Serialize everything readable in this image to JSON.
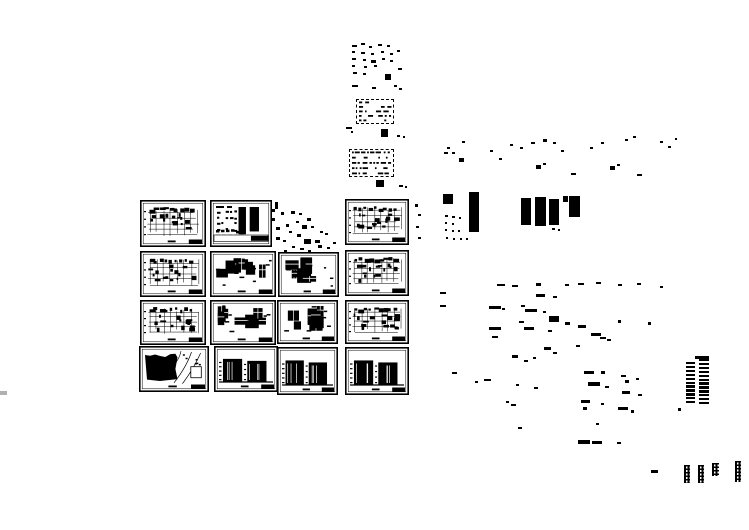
{
  "meta": {
    "title": "Architectural CAD drawing set preview",
    "bg": "#ffffff",
    "ink": "#000000",
    "canvas": {
      "width": 749,
      "height": 530
    }
  },
  "sheets": [
    {
      "id": "structural-plan-1",
      "kind": "plan-grid",
      "x": 140,
      "y": 200,
      "w": 66,
      "h": 47,
      "seed": 11
    },
    {
      "id": "heavy-wall-plan",
      "kind": "heavy-plan",
      "x": 210,
      "y": 200,
      "w": 62,
      "h": 47,
      "seed": 22
    },
    {
      "id": "floor-plan-1",
      "kind": "plan-grid",
      "x": 345,
      "y": 199,
      "w": 64,
      "h": 46,
      "seed": 33
    },
    {
      "id": "structural-plan-2",
      "kind": "plan-grid",
      "x": 140,
      "y": 251,
      "w": 66,
      "h": 46,
      "seed": 44
    },
    {
      "id": "detail-sheet-1",
      "kind": "detail-sheet",
      "x": 210,
      "y": 251,
      "w": 66,
      "h": 46,
      "seed": 55
    },
    {
      "id": "detail-sheet-2",
      "kind": "detail-sheet",
      "x": 278,
      "y": 252,
      "w": 61,
      "h": 45,
      "seed": 66
    },
    {
      "id": "floor-plan-2",
      "kind": "plan-grid",
      "x": 345,
      "y": 250,
      "w": 64,
      "h": 46,
      "seed": 77
    },
    {
      "id": "structural-plan-3",
      "kind": "plan-grid",
      "x": 140,
      "y": 300,
      "w": 66,
      "h": 45,
      "seed": 88
    },
    {
      "id": "detail-sheet-3",
      "kind": "detail-sheet",
      "x": 210,
      "y": 300,
      "w": 66,
      "h": 45,
      "seed": 99
    },
    {
      "id": "detail-sheet-4",
      "kind": "detail-sheet",
      "x": 277,
      "y": 300,
      "w": 61,
      "h": 44,
      "seed": 110
    },
    {
      "id": "floor-plan-3",
      "kind": "plan-grid",
      "x": 345,
      "y": 300,
      "w": 64,
      "h": 44,
      "seed": 121
    },
    {
      "id": "site-plan",
      "kind": "site-plan",
      "x": 139,
      "y": 346,
      "w": 70,
      "h": 46,
      "seed": 132
    },
    {
      "id": "elevation-1",
      "kind": "elevation",
      "x": 214,
      "y": 346,
      "w": 64,
      "h": 46,
      "seed": 143
    },
    {
      "id": "elevation-2",
      "kind": "elevation",
      "x": 277,
      "y": 347,
      "w": 61,
      "h": 48,
      "seed": 154
    },
    {
      "id": "elevation-3",
      "kind": "elevation",
      "x": 345,
      "y": 347,
      "w": 64,
      "h": 48,
      "seed": 165
    }
  ],
  "text_tables": [
    {
      "id": "spec-table-upper",
      "x": 356,
      "y": 99,
      "w": 36,
      "h": 23,
      "rows": 5,
      "seed": 7
    },
    {
      "id": "spec-table-lower",
      "x": 349,
      "y": 149,
      "w": 43,
      "h": 26,
      "rows": 5,
      "seed": 9
    }
  ],
  "tall_elevation": {
    "id": "high-rise-elevation",
    "top_bar": [
      695,
      356,
      14,
      3
    ],
    "columns": [
      {
        "x": 686,
        "w": 9,
        "y0": 362,
        "rows": 11
      },
      {
        "x": 699,
        "w": 10,
        "y0": 359,
        "rows": 12
      }
    ],
    "bar_h": 2.4,
    "pitch": 3.9
  },
  "dot_columns": [
    {
      "x": 684,
      "y": 465,
      "w": 6,
      "h": 18
    },
    {
      "x": 698,
      "y": 465,
      "w": 6,
      "h": 18
    },
    {
      "x": 712,
      "y": 463,
      "w": 7,
      "h": 13
    },
    {
      "x": 735,
      "y": 461,
      "w": 6,
      "h": 21
    }
  ],
  "marks": [
    [
      275,
      202,
      3,
      7
    ],
    [
      281,
      212,
      3,
      3
    ],
    [
      291,
      211,
      4,
      3
    ],
    [
      299,
      213,
      3,
      2
    ],
    [
      307,
      218,
      4,
      3
    ],
    [
      296,
      221,
      3,
      2
    ],
    [
      286,
      224,
      3,
      3
    ],
    [
      276,
      227,
      4,
      3
    ],
    [
      302,
      225,
      5,
      4
    ],
    [
      311,
      226,
      3,
      2
    ],
    [
      289,
      231,
      3,
      2
    ],
    [
      297,
      234,
      4,
      3
    ],
    [
      276,
      237,
      4,
      3
    ],
    [
      283,
      240,
      3,
      2
    ],
    [
      304,
      239,
      7,
      5
    ],
    [
      315,
      240,
      5,
      3
    ],
    [
      292,
      246,
      3,
      2
    ],
    [
      300,
      248,
      4,
      2
    ],
    [
      284,
      250,
      3,
      2
    ],
    [
      308,
      250,
      3,
      2
    ],
    [
      272,
      209,
      3,
      3
    ],
    [
      272,
      218,
      3,
      3
    ],
    [
      320,
      231,
      3,
      2
    ],
    [
      325,
      233,
      3,
      2
    ],
    [
      318,
      245,
      4,
      3
    ],
    [
      327,
      247,
      3,
      2
    ],
    [
      333,
      242,
      3,
      2
    ],
    [
      415,
      204,
      3,
      3
    ],
    [
      418,
      214,
      3,
      2
    ],
    [
      416,
      226,
      3,
      2
    ],
    [
      418,
      237,
      3,
      2
    ],
    [
      352,
      45,
      5,
      2
    ],
    [
      361,
      43,
      4,
      2
    ],
    [
      369,
      46,
      3,
      2
    ],
    [
      378,
      44,
      4,
      2
    ],
    [
      387,
      45,
      3,
      2
    ],
    [
      397,
      50,
      3,
      2
    ],
    [
      352,
      51,
      3,
      2
    ],
    [
      361,
      52,
      4,
      2
    ],
    [
      371,
      53,
      3,
      2
    ],
    [
      381,
      51,
      3,
      2
    ],
    [
      390,
      53,
      3,
      2
    ],
    [
      352,
      58,
      4,
      2
    ],
    [
      363,
      59,
      3,
      2
    ],
    [
      371,
      60,
      5,
      3
    ],
    [
      382,
      58,
      3,
      2
    ],
    [
      390,
      60,
      3,
      2
    ],
    [
      352,
      65,
      3,
      2
    ],
    [
      364,
      66,
      3,
      2
    ],
    [
      374,
      65,
      3,
      2
    ],
    [
      353,
      72,
      4,
      2
    ],
    [
      363,
      73,
      3,
      2
    ],
    [
      385,
      74,
      6,
      6
    ],
    [
      398,
      68,
      4,
      2
    ],
    [
      352,
      85,
      6,
      2
    ],
    [
      372,
      87,
      4,
      2
    ],
    [
      394,
      85,
      3,
      2
    ],
    [
      399,
      88,
      3,
      2
    ],
    [
      346,
      127,
      6,
      2
    ],
    [
      351,
      131,
      2,
      2
    ],
    [
      381,
      129,
      7,
      8
    ],
    [
      397,
      135,
      3,
      2
    ],
    [
      403,
      136,
      2,
      2
    ],
    [
      376,
      180,
      8,
      7
    ],
    [
      399,
      185,
      4,
      2
    ],
    [
      405,
      186,
      2,
      2
    ],
    [
      447,
      147,
      3,
      2
    ],
    [
      444,
      152,
      4,
      2
    ],
    [
      452,
      152,
      3,
      2
    ],
    [
      459,
      158,
      5,
      4
    ],
    [
      462,
      141,
      3,
      2
    ],
    [
      490,
      150,
      3,
      2
    ],
    [
      499,
      158,
      3,
      2
    ],
    [
      510,
      144,
      3,
      2
    ],
    [
      520,
      147,
      3,
      2
    ],
    [
      531,
      142,
      4,
      2
    ],
    [
      543,
      139,
      4,
      3
    ],
    [
      553,
      142,
      3,
      2
    ],
    [
      561,
      150,
      3,
      2
    ],
    [
      536,
      165,
      5,
      4
    ],
    [
      543,
      163,
      3,
      2
    ],
    [
      571,
      173,
      5,
      2
    ],
    [
      590,
      147,
      3,
      2
    ],
    [
      601,
      142,
      3,
      2
    ],
    [
      610,
      166,
      5,
      4
    ],
    [
      617,
      164,
      3,
      2
    ],
    [
      637,
      174,
      5,
      2
    ],
    [
      625,
      139,
      3,
      2
    ],
    [
      633,
      136,
      3,
      2
    ],
    [
      660,
      141,
      3,
      2
    ],
    [
      668,
      146,
      3,
      2
    ],
    [
      675,
      138,
      2,
      2
    ],
    [
      443,
      194,
      10,
      10
    ],
    [
      469,
      192,
      10,
      40
    ],
    [
      445,
      215,
      3,
      2
    ],
    [
      452,
      216,
      3,
      2
    ],
    [
      459,
      217,
      2,
      2
    ],
    [
      445,
      222,
      2,
      2
    ],
    [
      452,
      223,
      2,
      2
    ],
    [
      445,
      229,
      2,
      2
    ],
    [
      452,
      230,
      2,
      2
    ],
    [
      458,
      230,
      2,
      2
    ],
    [
      446,
      237,
      2,
      2
    ],
    [
      453,
      238,
      2,
      2
    ],
    [
      460,
      238,
      2,
      2
    ],
    [
      466,
      238,
      2,
      2
    ],
    [
      521,
      198,
      10,
      27
    ],
    [
      535,
      197,
      11,
      29
    ],
    [
      549,
      199,
      10,
      26
    ],
    [
      563,
      196,
      5,
      6
    ],
    [
      569,
      196,
      11,
      21
    ],
    [
      552,
      228,
      3,
      2
    ],
    [
      558,
      229,
      2,
      2
    ],
    [
      497,
      284,
      8,
      2
    ],
    [
      512,
      285,
      6,
      2
    ],
    [
      536,
      283,
      5,
      3
    ],
    [
      565,
      284,
      4,
      2
    ],
    [
      578,
      283,
      6,
      2
    ],
    [
      596,
      282,
      5,
      2
    ],
    [
      618,
      284,
      4,
      2
    ],
    [
      637,
      283,
      4,
      2
    ],
    [
      660,
      286,
      3,
      2
    ],
    [
      440,
      292,
      6,
      2
    ],
    [
      440,
      305,
      6,
      2
    ],
    [
      536,
      294,
      9,
      3
    ],
    [
      553,
      296,
      4,
      2
    ],
    [
      489,
      306,
      12,
      3
    ],
    [
      502,
      308,
      3,
      2
    ],
    [
      521,
      305,
      4,
      2
    ],
    [
      525,
      309,
      12,
      3
    ],
    [
      543,
      311,
      3,
      2
    ],
    [
      549,
      316,
      10,
      6
    ],
    [
      565,
      322,
      5,
      3
    ],
    [
      519,
      321,
      5,
      2
    ],
    [
      489,
      327,
      12,
      3
    ],
    [
      524,
      327,
      10,
      3
    ],
    [
      548,
      330,
      4,
      2
    ],
    [
      578,
      325,
      8,
      3
    ],
    [
      618,
      320,
      3,
      3
    ],
    [
      648,
      322,
      3,
      3
    ],
    [
      591,
      333,
      10,
      3
    ],
    [
      600,
      337,
      6,
      2
    ],
    [
      607,
      339,
      4,
      2
    ],
    [
      492,
      336,
      6,
      2
    ],
    [
      544,
      347,
      7,
      3
    ],
    [
      553,
      352,
      4,
      2
    ],
    [
      576,
      345,
      4,
      2
    ],
    [
      512,
      355,
      6,
      3
    ],
    [
      524,
      360,
      4,
      2
    ],
    [
      533,
      357,
      3,
      2
    ],
    [
      452,
      372,
      5,
      2
    ],
    [
      475,
      381,
      3,
      2
    ],
    [
      484,
      379,
      7,
      2
    ],
    [
      516,
      384,
      3,
      2
    ],
    [
      534,
      387,
      4,
      2
    ],
    [
      506,
      401,
      3,
      2
    ],
    [
      511,
      404,
      5,
      2
    ],
    [
      584,
      371,
      10,
      3
    ],
    [
      601,
      371,
      4,
      3
    ],
    [
      621,
      375,
      5,
      2
    ],
    [
      588,
      382,
      12,
      4
    ],
    [
      605,
      386,
      4,
      2
    ],
    [
      625,
      380,
      4,
      3
    ],
    [
      636,
      378,
      3,
      2
    ],
    [
      622,
      391,
      8,
      3
    ],
    [
      638,
      394,
      4,
      2
    ],
    [
      581,
      400,
      9,
      3
    ],
    [
      601,
      403,
      3,
      2
    ],
    [
      583,
      407,
      4,
      3
    ],
    [
      618,
      407,
      10,
      3
    ],
    [
      631,
      410,
      3,
      3
    ],
    [
      596,
      423,
      3,
      2
    ],
    [
      518,
      427,
      4,
      2
    ],
    [
      578,
      440,
      12,
      4
    ],
    [
      592,
      441,
      10,
      3
    ],
    [
      617,
      442,
      4,
      2
    ],
    [
      651,
      470,
      7,
      3
    ],
    [
      678,
      408,
      3,
      3
    ],
    [
      0,
      391,
      7,
      4,
      "#b0b0b0"
    ]
  ]
}
